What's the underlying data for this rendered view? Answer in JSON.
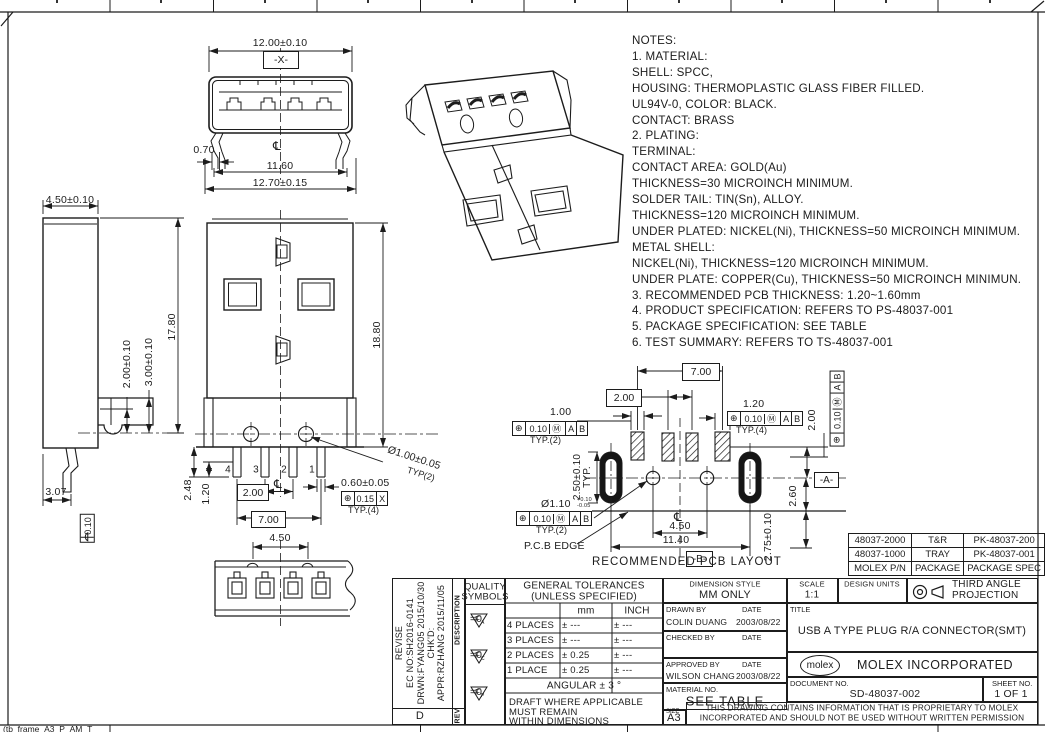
{
  "frame": {
    "bottom_label": "(tb_frame_A3_P_AM_T"
  },
  "notes": {
    "lines": [
      "NOTES:",
      "1. MATERIAL:",
      "SHELL: SPCC,",
      "HOUSING: THERMOPLASTIC  GLASS FIBER FILLED.",
      "UL94V-0, COLOR: BLACK.",
      "CONTACT: BRASS",
      "2. PLATING:",
      "TERMINAL:",
      "CONTACT AREA: GOLD(Au)",
      "THICKNESS=30 MICROINCH MINIMUM.",
      "SOLDER TAIL: TIN(Sn), ALLOY.",
      "THICKNESS=120 MICROINCH MINIMUM.",
      "UNDER PLATED: NICKEL(Ni), THICKNESS=50 MICROINCH MINIMUM.",
      "METAL SHELL:",
      "NICKEL(Ni), THICKNESS=120 MICROINCH MINIMUM.",
      "UNDER PLATE: COPPER(Cu), THICKNESS=50 MICROINCH MINIMUN.",
      "3. RECOMMENDED PCB THICKNESS: 1.20~1.60mm",
      "4. PRODUCT SPECIFICATION: REFERS TO PS-48037-001",
      "5. PACKAGE SPECIFICATION: SEE TABLE",
      "6. TEST SUMMARY: REFERS TO TS-48037-001"
    ]
  },
  "views": {
    "front": {
      "w": "12.00±0.10",
      "datum_x": "-X-",
      "lead": "0.70",
      "inner_w": "11.60",
      "outer_w": "12.70±0.15",
      "cl": "℄"
    },
    "side": {
      "depth": "4.50±0.10",
      "height": "17.80",
      "d1": "2.00±0.10",
      "d2": "3.00±0.10",
      "d3": "3.07",
      "flatness": "0.10"
    },
    "main": {
      "height": "18.80",
      "pins": [
        "4",
        "3",
        "2",
        "1"
      ],
      "d1": "2.48",
      "d2": "1.20",
      "pitch": "2.00",
      "span": "7.00",
      "pin_w": "0.60±0.05",
      "fcf": {
        "pos": "⊕",
        "val": "0.15",
        "dat": "X"
      },
      "typ4": "TYP.(4)",
      "peg": "Ø1.00±0.05",
      "typ2": "TYP(2)",
      "cl": "℄"
    },
    "bottom": {
      "d1": "4.50"
    },
    "pcb": {
      "caption": "RECOMMENDED PCB LAYOUT",
      "edge": "P.C.B EDGE",
      "span": "7.00",
      "pitch": "2.00",
      "pad1": "1.00",
      "pad4": "1.20",
      "fcf": {
        "pos": "⊕",
        "val": "0.10",
        "mod": "Ⓜ",
        "a": "A",
        "b": "B"
      },
      "typ2": "TYP.(2)",
      "typ4": "TYP.(4)",
      "right_d": "2.00",
      "slot": "2.50±0.10",
      "slot_typ": "TYP.",
      "hole": "Ø1.10",
      "hole_tol_u": "+0.10",
      "hole_tol_d": "-0.05",
      "d260": "2.60",
      "d275": "2.75±0.10",
      "d450": "4.50",
      "d1140": "11.40",
      "datum_a": "-A-",
      "datum_b": "-B-",
      "cl": "℄"
    }
  },
  "package_table": {
    "rows": [
      [
        "48037-2000",
        "T&R",
        "PK-48037-200"
      ],
      [
        "48037-1000",
        "TRAY",
        "PK-48037-001"
      ],
      [
        "MOLEX P/N",
        "PACKAGE",
        "PACKAGE SPEC"
      ]
    ]
  },
  "revision": {
    "lines": [
      "REVISE",
      "EC NO:SH2016-0141",
      "DRWN:FYANG05 2015/10/30",
      "CHK'D:",
      "APPR:RZHANG 2015/11/05"
    ],
    "description": "DESCRIPTION",
    "rev_label": "REV",
    "rev": "D"
  },
  "quality": {
    "header1": "QUALITY",
    "header2": "SYMBOLS",
    "f": "F",
    "subs": [
      "A",
      "C",
      "P"
    ],
    "eq": "=0"
  },
  "tolerance": {
    "h1": "GENERAL TOLERANCES",
    "h2": "(UNLESS SPECIFIED)",
    "mm": "mm",
    "inch": "INCH",
    "rows": [
      [
        "4 PLACES",
        "± ---",
        "± ---"
      ],
      [
        "3 PLACES",
        "± ---",
        "± ---"
      ],
      [
        "2 PLACES",
        "± 0.25",
        "± ---"
      ],
      [
        "1 PLACE",
        "± 0.25",
        "± ---"
      ]
    ],
    "angular": "ANGULAR ± 3 °",
    "draft1": "DRAFT WHERE APPLICABLE",
    "draft2": "MUST REMAIN",
    "draft3": "WITHIN DIMENSIONS"
  },
  "title_block": {
    "dim_style_label": "DIMENSION STYLE",
    "dim_style": "MM ONLY",
    "scale_label": "SCALE",
    "scale": "1:1",
    "units_label": "DESIGN UNITS",
    "proj1": "THIRD ANGLE",
    "proj2": "PROJECTION",
    "drawn_label": "DRAWN BY",
    "date_label": "DATE",
    "drawn": "COLIN DUANG",
    "drawn_date": "2003/08/22",
    "checked_label": "CHECKED BY",
    "approved_label": "APPROVED BY",
    "approved": "WILSON CHANG",
    "approved_date": "2003/08/22",
    "title_label": "TITLE",
    "title": "USB A TYPE PLUG R/A CONNECTOR(SMT)",
    "logo": "molex",
    "company": "MOLEX INCORPORATED",
    "material_label": "MATERIAL NO.",
    "material": "SEE TABLE",
    "doc_label": "DOCUMENT NO.",
    "doc": "SD-48037-002",
    "sheet_label": "SHEET NO.",
    "sheet": "1 OF 1",
    "size_label": "SIZE",
    "size": "A3",
    "prop1": "THIS DRAWING CONTAINS INFORMATION THAT IS PROPRIETARY TO MOLEX",
    "prop2": "INCORPORATED AND SHOULD NOT BE USED WITHOUT WRITTEN PERMISSION"
  }
}
